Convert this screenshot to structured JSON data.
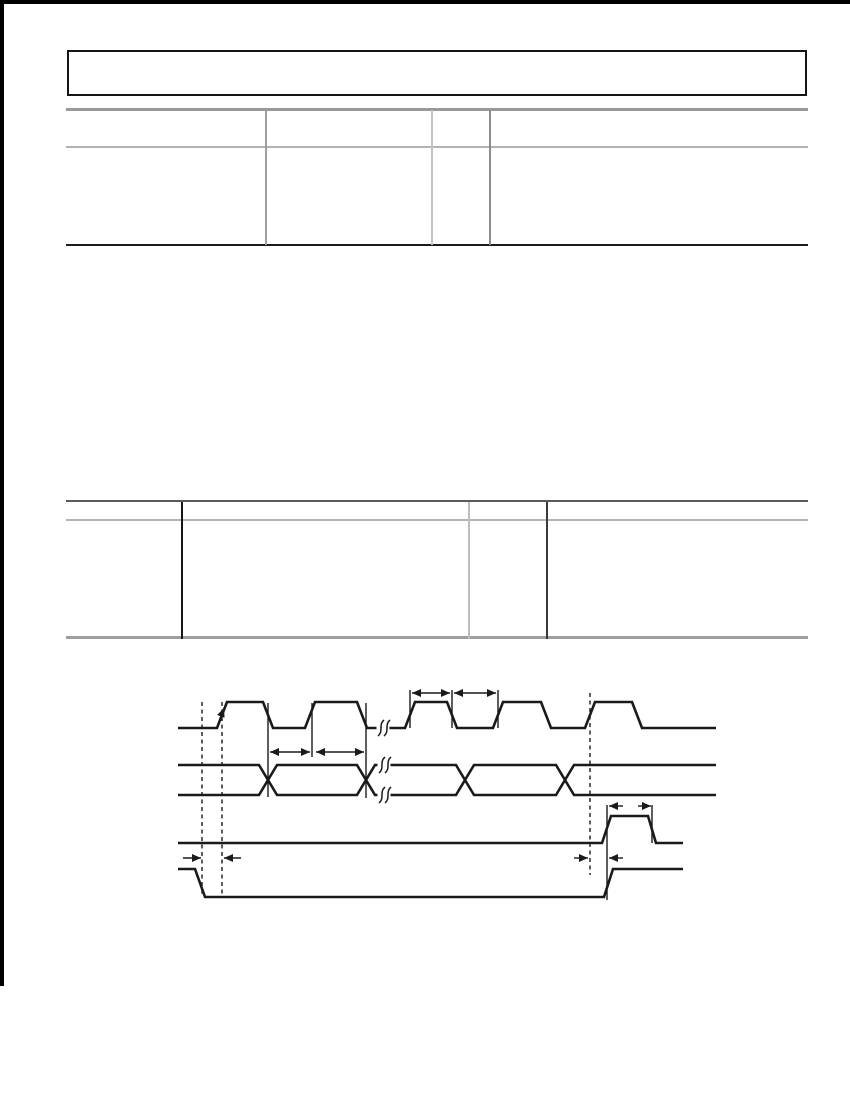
{
  "page": {
    "width": 850,
    "height": 1100,
    "background": "#ffffff",
    "scan_edges": [
      {
        "name": "scan-edge-top",
        "x": 0,
        "y": 0,
        "w": 850,
        "h": 4,
        "color": "#000000"
      },
      {
        "name": "scan-edge-left",
        "x": 0,
        "y": 0,
        "w": 4,
        "h": 986,
        "color": "#000000"
      }
    ]
  },
  "header_box": {
    "x": 67,
    "y": 50,
    "w": 740,
    "h": 46,
    "border_width": 2,
    "border_color": "#141414",
    "fill": "#ffffff"
  },
  "tables": [
    {
      "name": "spec-table-1",
      "hlines": [
        {
          "y": 109,
          "x1": 66,
          "x2": 808,
          "w": 3,
          "color": "#999999"
        },
        {
          "y": 147,
          "x1": 66,
          "x2": 808,
          "w": 1.5,
          "color": "#b3b3b3"
        },
        {
          "y": 245,
          "x1": 66,
          "x2": 808,
          "w": 2.5,
          "color": "#1c1c1c"
        }
      ],
      "vlines": [
        {
          "x": 266,
          "y1": 110,
          "y2": 245,
          "w": 1.5,
          "color": "#9e9e9e"
        },
        {
          "x": 432,
          "y1": 110,
          "y2": 245,
          "w": 1.5,
          "color": "#c2c2c2"
        },
        {
          "x": 490,
          "y1": 110,
          "y2": 245,
          "w": 1.5,
          "color": "#8c8c8c"
        }
      ]
    },
    {
      "name": "spec-table-2",
      "hlines": [
        {
          "y": 501,
          "x1": 66,
          "x2": 808,
          "w": 1.8,
          "color": "#5a5a5a"
        },
        {
          "y": 520,
          "x1": 66,
          "x2": 808,
          "w": 1.5,
          "color": "#b3b3b3"
        },
        {
          "y": 637,
          "x1": 66,
          "x2": 808,
          "w": 3,
          "color": "#9e9e9e"
        }
      ],
      "vlines": [
        {
          "x": 182,
          "y1": 502,
          "y2": 639,
          "w": 1.5,
          "color": "#161616"
        },
        {
          "x": 469,
          "y1": 502,
          "y2": 639,
          "w": 1.5,
          "color": "#bdbdbd"
        },
        {
          "x": 547,
          "y1": 502,
          "y2": 639,
          "w": 1.5,
          "color": "#3a3a3a"
        }
      ]
    }
  ],
  "diagram": {
    "stroke": "#1a1a1a",
    "signal_width": 2.6,
    "thin_width": 1.4,
    "signals": [
      {
        "name": "clock-waveform",
        "points": [
          [
            178,
            728
          ],
          [
            217,
            728
          ],
          [
            227,
            702
          ],
          [
            263,
            702
          ],
          [
            273,
            728
          ],
          [
            305,
            728
          ],
          [
            315,
            702
          ],
          [
            357,
            702
          ],
          [
            367,
            728
          ],
          [
            405,
            728
          ],
          [
            415,
            702
          ],
          [
            447,
            702
          ],
          [
            457,
            728
          ],
          [
            493,
            728
          ],
          [
            503,
            702
          ],
          [
            541,
            702
          ],
          [
            551,
            728
          ],
          [
            585,
            728
          ],
          [
            595,
            702
          ],
          [
            632,
            702
          ],
          [
            642,
            728
          ],
          [
            716,
            728
          ]
        ]
      },
      {
        "name": "bus-waveform-upper",
        "points": [
          [
            178,
            765
          ],
          [
            259,
            765
          ],
          [
            277,
            795
          ],
          [
            357,
            795
          ],
          [
            375,
            765
          ],
          [
            456,
            765
          ],
          [
            474,
            795
          ],
          [
            556,
            795
          ],
          [
            574,
            765
          ],
          [
            716,
            765
          ]
        ]
      },
      {
        "name": "bus-waveform-lower",
        "points": [
          [
            178,
            795
          ],
          [
            259,
            795
          ],
          [
            277,
            765
          ],
          [
            357,
            765
          ],
          [
            375,
            795
          ],
          [
            456,
            795
          ],
          [
            474,
            765
          ],
          [
            556,
            765
          ],
          [
            574,
            795
          ],
          [
            716,
            795
          ]
        ]
      },
      {
        "name": "pulse-waveform",
        "points": [
          [
            178,
            843
          ],
          [
            602,
            843
          ],
          [
            611,
            816
          ],
          [
            648,
            816
          ],
          [
            656,
            843
          ],
          [
            683,
            843
          ]
        ]
      },
      {
        "name": "enable-waveform",
        "points": [
          [
            178,
            869
          ],
          [
            195,
            869
          ],
          [
            205,
            897
          ],
          [
            604,
            897
          ],
          [
            613,
            869
          ],
          [
            683,
            869
          ]
        ]
      }
    ],
    "dashed_lines": [
      {
        "name": "dashed-marker-1",
        "x": 202,
        "y1": 702,
        "y2": 897
      },
      {
        "name": "dashed-marker-2",
        "x": 222,
        "y1": 702,
        "y2": 897
      },
      {
        "name": "dashed-marker-3",
        "x": 590,
        "y1": 693,
        "y2": 875
      }
    ],
    "vertical_lines": [
      {
        "x": 268,
        "y1": 703,
        "y2": 797
      },
      {
        "x": 312,
        "y1": 703,
        "y2": 757
      },
      {
        "x": 366,
        "y1": 703,
        "y2": 798
      },
      {
        "x": 410,
        "y1": 690,
        "y2": 728
      },
      {
        "x": 452,
        "y1": 690,
        "y2": 728
      },
      {
        "x": 498,
        "y1": 690,
        "y2": 728
      },
      {
        "x": 607,
        "y1": 805,
        "y2": 900
      },
      {
        "x": 652,
        "y1": 805,
        "y2": 843
      }
    ],
    "dimension_arrows": [
      {
        "x1": 412,
        "y1": 693,
        "x2": 450,
        "y2": 693,
        "start": true,
        "end": true
      },
      {
        "x1": 454,
        "y1": 693,
        "x2": 496,
        "y2": 693,
        "start": true,
        "end": true
      },
      {
        "x1": 270,
        "y1": 752,
        "x2": 310,
        "y2": 752,
        "start": true,
        "end": true
      },
      {
        "x1": 316,
        "y1": 752,
        "x2": 364,
        "y2": 752,
        "start": true,
        "end": true
      },
      {
        "x1": 623,
        "y1": 806,
        "x2": 609,
        "y2": 806,
        "end": true
      },
      {
        "x1": 638,
        "y1": 806,
        "x2": 651,
        "y2": 806,
        "end": true
      },
      {
        "x1": 183,
        "y1": 858,
        "x2": 201,
        "y2": 858,
        "end": true
      },
      {
        "x1": 241,
        "y1": 858,
        "x2": 224,
        "y2": 858,
        "end": true
      },
      {
        "x1": 574,
        "y1": 858,
        "x2": 588,
        "y2": 858,
        "end": true
      },
      {
        "x1": 623,
        "y1": 858,
        "x2": 609,
        "y2": 858,
        "end": true
      },
      {
        "x1": 218,
        "y1": 724,
        "x2": 224,
        "y2": 708,
        "end": true,
        "name": "clock-edge-arrow"
      }
    ],
    "breaks": [
      {
        "x": 381,
        "y": 728
      },
      {
        "x": 382,
        "y": 765
      },
      {
        "x": 382,
        "y": 795
      }
    ]
  }
}
